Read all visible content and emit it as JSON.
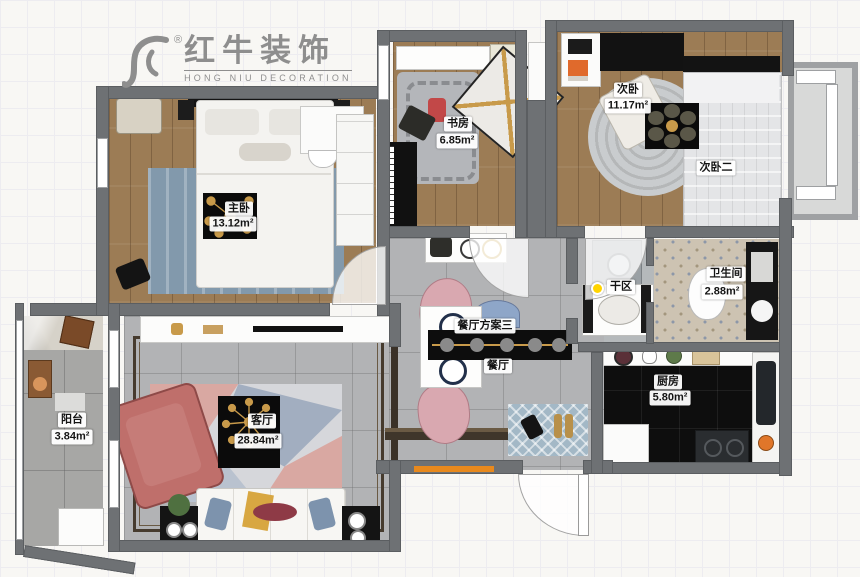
{
  "logo": {
    "brand": "红牛装饰",
    "subtitle": "HONG NIU DECORATION",
    "registered": "®"
  },
  "rooms": {
    "master": {
      "label": "主卧",
      "area": "13.12m²"
    },
    "study": {
      "label": "书房",
      "area": "6.85m²"
    },
    "bedroom2": {
      "label": "次卧",
      "area": "11.17m²"
    },
    "bedroom2b": {
      "label": "次卧二"
    },
    "bathroom": {
      "label": "卫生间",
      "area": "2.88m²"
    },
    "dry_area": {
      "label": "干区"
    },
    "kitchen": {
      "label": "厨房",
      "area": "5.80m²"
    },
    "dining_plan": {
      "label": "餐厅方案三"
    },
    "dining": {
      "label": "餐厅"
    },
    "living": {
      "label": "客厅",
      "area": "28.84m²"
    },
    "balcony": {
      "label": "阳台",
      "area": "3.84m²"
    }
  },
  "colors": {
    "wall": "#6e7174",
    "wood_floor": "#9c7c55",
    "tile_floor": "#b2b3b5",
    "kitchen_floor": "#0e0e0e",
    "accent_pink": "#d9a8a2",
    "rug_blue": "#8299ac",
    "mat_blue": "#a3b8c6",
    "marker_yellow": "#ffd400",
    "shoe_cabinet_orange": "#e8891d",
    "gold": "#c89a4a"
  }
}
